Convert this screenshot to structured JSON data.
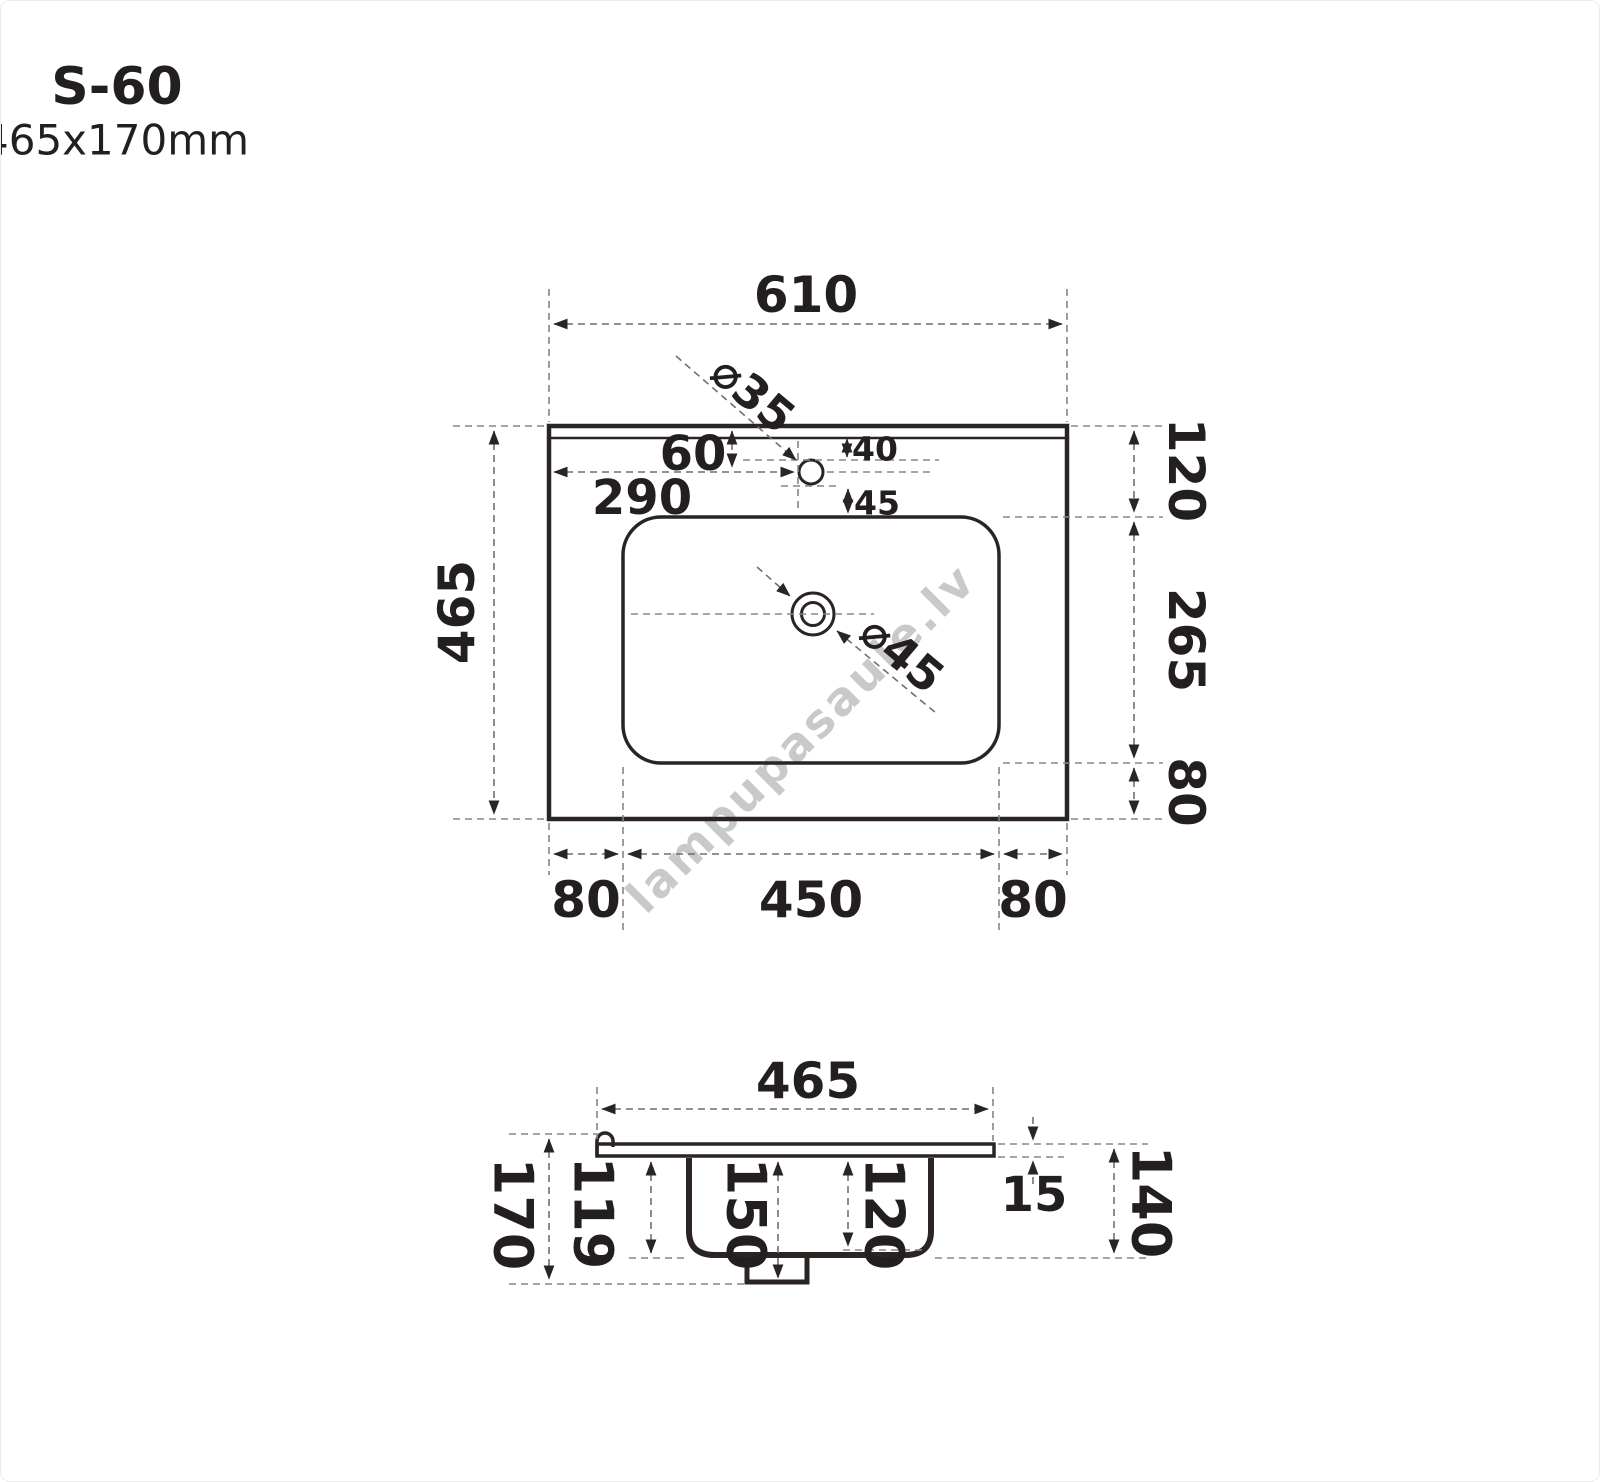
{
  "header": {
    "model": "S-60",
    "overall_size": "610x465x170mm"
  },
  "watermark": "lampupasaule.lv",
  "top_view": {
    "width": "610",
    "depth": "465",
    "right_top": "120",
    "right_middle": "265",
    "right_bottom": "80",
    "bottom_left": "80",
    "bottom_center": "450",
    "bottom_right": "80",
    "faucet_from_left": "290",
    "faucet_from_top": "60",
    "hole_top_offset": "40",
    "hole_bottom_offset": "45",
    "faucet_hole_diameter": "⌀35",
    "drain_diameter": "⌀45"
  },
  "side_view": {
    "depth": "465",
    "total_height": "170",
    "bowl_outer_depth": "119",
    "bowl_to_drain_depth": "150",
    "bowl_inner_depth": "120",
    "slab_thickness": "15",
    "right_height": "140"
  }
}
